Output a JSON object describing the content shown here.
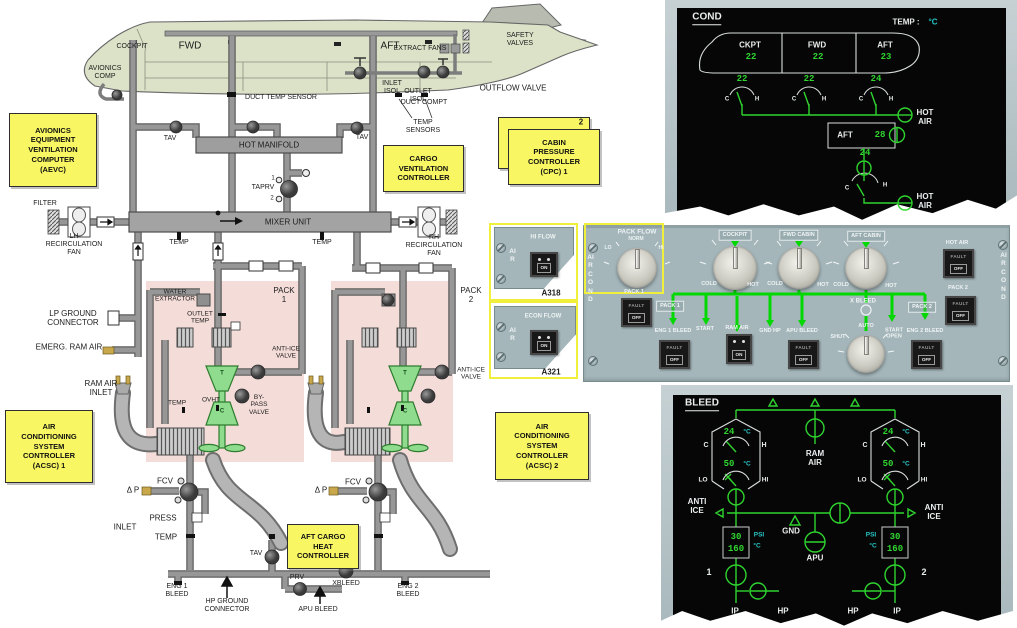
{
  "diagram": {
    "aircraft": {
      "cockpit": "COCKPIT",
      "fwd": "FWD",
      "aft": "AFT",
      "avionics_comp": "AVIONICS\nCOMP",
      "extract_fans": "EXTRACT FANS",
      "safety_valves": "SAFETY\nVALVES",
      "inlet_isol": "INLET\nISOL",
      "outlet_isol": "OUTLET\nISOL",
      "outflow_valve": "OUTFLOW VALVE",
      "duct_temp_sensor": "DUCT TEMP SENSOR",
      "duct_compt": "DUCT COMPT",
      "temp_sensors": "TEMP\nSENSORS"
    },
    "labels": {
      "tav_left": "TAV",
      "tav_right": "TAV",
      "tav_bottom": "TAV",
      "hot_manifold": "HOT MANIFOLD",
      "taprv": "TAPRV",
      "taprv_1": "1",
      "taprv_2": "2",
      "filter": "FILTER",
      "lh_recirc": "LH\nRECIRCULATION\nFAN",
      "rh_recirc": "RH\nRECIRCULATION\nFAN",
      "mixer_unit": "MIXER UNIT",
      "temp_left": "TEMP",
      "temp_right": "TEMP",
      "lp_ground": "LP GROUND\nCONNECTOR",
      "emerg_ram_air": "EMERG. RAM AIR",
      "ram_air_inlet": "RAM  AIR\nINLET",
      "pack1": "PACK\n1",
      "pack2": "PACK\n2",
      "water_extractor": "WATER\nEXTRACTOR",
      "outlet_temp": "OUTLET\nTEMP",
      "anti_ice_valve1": "ANTI-ICE\nVALVE",
      "anti_ice_valve2": "ANTI-ICE\nVALVE",
      "temp_pack": "TEMP",
      "ovht": "OVHT",
      "bypass_valve": "BY-\nPASS\nVALVE",
      "turbine1": "T",
      "compressor1": "C",
      "turbine2": "T",
      "compressor2": "C",
      "fcv1": "FCV",
      "fcv2": "FCV",
      "dp1": "Δ P",
      "dp2": "Δ P",
      "inlet": "INLET",
      "press": "PRESS",
      "temp_bleed": "TEMP",
      "eng1_bleed": "ENG 1\nBLEED",
      "eng2_bleed": "ENG 2\nBLEED",
      "hp_ground": "HP GROUND\nCONNECTOR",
      "prv": "PRV",
      "xbleed": "XBLEED",
      "apu_bleed": "APU BLEED"
    },
    "boxes": {
      "aevc": "AVIONICS\nEQUIPMENT\nVENTILATION\nCOMPUTER\n(AEVC)",
      "cargo_vent": "CARGO\nVENTILATION\nCONTROLLER",
      "cpc": "CABIN\nPRESSURE\nCONTROLLER\n(CPC) 1",
      "cpc2_tag": "2",
      "acsc1": "AIR\nCONDITIONING\nSYSTEM\nCONTROLLER\n(ACSC) 1",
      "acsc2": "AIR\nCONDITIONING\nSYSTEM\nCONTROLLER\n(ACSC) 2",
      "aft_cargo_heat": "AFT CARGO\nHEAT\nCONTROLLER"
    }
  },
  "cond": {
    "title": "COND",
    "temp_label": "TEMP :",
    "temp_unit": "°C",
    "zones": [
      {
        "name": "CKPT",
        "cabin": "22",
        "duct": "22"
      },
      {
        "name": "FWD",
        "cabin": "22",
        "duct": "22"
      },
      {
        "name": "AFT",
        "cabin": "23",
        "duct": "24"
      }
    ],
    "c": "C",
    "h": "H",
    "hot_air1": "HOT\nAIR",
    "hot_air2": "HOT\nAIR",
    "aft_cargo": {
      "label": "AFT",
      "hot_air_temp": "28",
      "duct": "24",
      "c": "C",
      "h": "H"
    }
  },
  "panel": {
    "variants": [
      {
        "flow": "HI FLOW",
        "on": "ON",
        "side": "AIR",
        "model": "A318"
      },
      {
        "flow": "ECON FLOW",
        "on": "ON",
        "side": "AIR",
        "model": "A321"
      }
    ],
    "side_left": "AIR COND",
    "side_right": "AIR COND",
    "pack_flow": {
      "label": "PACK FLOW",
      "norm": "NORM",
      "lo": "LO",
      "hi": "HI"
    },
    "knobs": [
      {
        "label": "COCKPIT",
        "cold": "COLD",
        "hot": "HOT"
      },
      {
        "label": "FWD CABIN",
        "cold": "COLD",
        "hot": "HOT"
      },
      {
        "label": "AFT CABIN",
        "cold": "COLD",
        "hot": "HOT"
      }
    ],
    "xbleed": {
      "label": "X BLEED",
      "shut": "SHUT",
      "auto": "AUTO",
      "start_open": "START\nOPEN"
    },
    "fault": "FAULT",
    "off": "OFF",
    "on": "ON",
    "tags": {
      "pack1": "PACK 1",
      "pack2": "PACK 2"
    },
    "labels": {
      "pack1_btn": "PACK 1",
      "pack2_btn": "PACK 2",
      "eng1_bleed": "ENG 1 BLEED",
      "eng2_bleed": "ENG 2 BLEED",
      "start": "START",
      "ram_air": "RAM AIR",
      "gnd_hp": "GND HP",
      "apu_bleed": "APU BLEED",
      "hot_air": "HOT AIR"
    }
  },
  "bleed": {
    "title": "BLEED",
    "ram_air": "RAM\nAIR",
    "anti_ice": "ANTI\nICE",
    "c": "C",
    "h": "H",
    "lo": "LO",
    "hi": "HI",
    "packs": [
      {
        "temp": "24",
        "temp_unit": "°C",
        "press": "50",
        "press_unit": "°C"
      },
      {
        "temp": "24",
        "temp_unit": "°C",
        "press": "50",
        "press_unit": "°C"
      }
    ],
    "gnd": "GND",
    "apu": "APU",
    "engines": [
      {
        "num": "1",
        "psi_label": "PSI",
        "temp_label": "°C",
        "psi": "30",
        "temp": "160",
        "ip": "IP",
        "hp": "HP"
      },
      {
        "num": "2",
        "psi_label": "PSI",
        "temp_label": "°C",
        "psi": "30",
        "temp": "160",
        "ip": "IP",
        "hp": "HP"
      }
    ]
  }
}
